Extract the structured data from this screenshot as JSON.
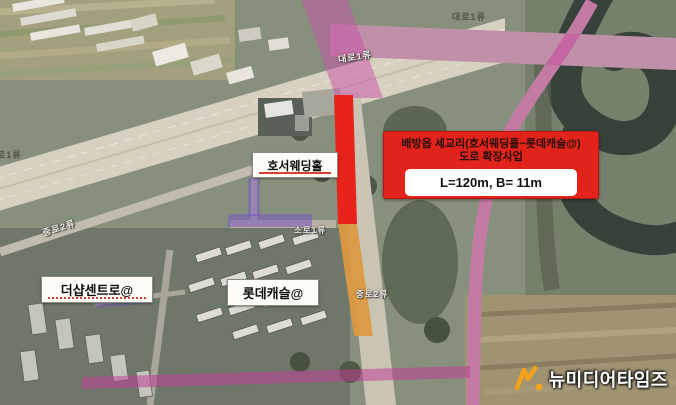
{
  "info_box": {
    "title_line1": "배방읍 세교리(호서웨딩홀~롯데캐슬@)",
    "title_line2": "도로 확장사업",
    "spec": "L=120m, B= 11m"
  },
  "place_labels": {
    "wedding_hall": "호서웨딩홀",
    "thesharp": "더샵센트로@",
    "lotte_castle": "롯데캐슬@"
  },
  "road_labels": [
    {
      "id": "daero-1-top",
      "text": "대로1류"
    },
    {
      "id": "daero-1-mid",
      "text": "대로1류"
    },
    {
      "id": "daero-1-left",
      "text": "로1류"
    },
    {
      "id": "jungro-2-left",
      "text": "중로2류"
    },
    {
      "id": "soro-1-center",
      "text": "소로1류"
    },
    {
      "id": "jungro-2-south",
      "text": "중로2류"
    }
  ],
  "watermark": {
    "text": "뉴미디어타임즈"
  },
  "colors": {
    "highlight_red": "#e7231b",
    "highlight_orange": "#db9a43",
    "overlay_pink": "#c752a8",
    "overlay_purple": "#7858c4",
    "watermark_orange": "#f6a21c"
  }
}
